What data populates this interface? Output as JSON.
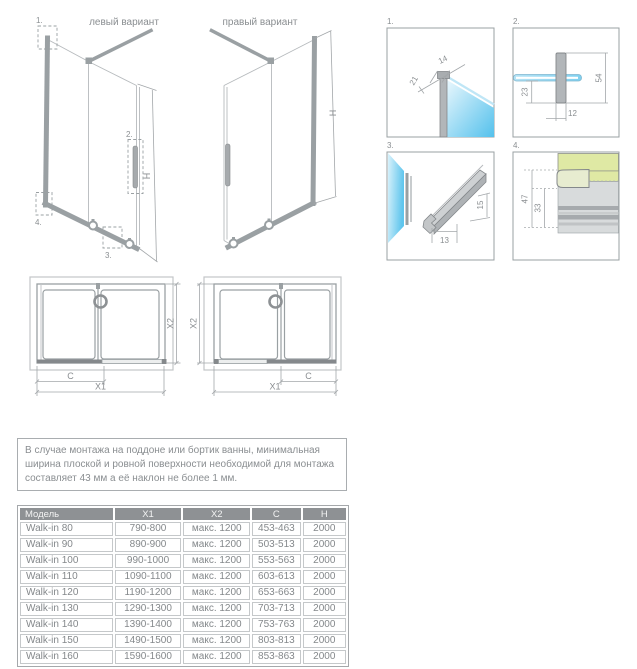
{
  "diagrams": {
    "left_variant": {
      "title": "левый вариант",
      "h_label": "H",
      "callouts": [
        "1.",
        "2.",
        "3.",
        "4."
      ]
    },
    "right_variant": {
      "title": "правый вариант",
      "h_label": "H"
    },
    "details": [
      {
        "number": "1.",
        "dims": [
          "21",
          "14"
        ]
      },
      {
        "number": "2.",
        "dims": [
          "54",
          "23",
          "12"
        ]
      },
      {
        "number": "3.",
        "dims": [
          "13",
          "15"
        ]
      },
      {
        "number": "4.",
        "dims": [
          "47",
          "33"
        ]
      }
    ],
    "plans": {
      "left": {
        "c": "C",
        "x1": "X1",
        "x2": "X2"
      },
      "right": {
        "c": "C",
        "x1": "X1",
        "x2": "X2"
      }
    }
  },
  "note": "В случае монтажа на поддоне или бортик ванны, минимальная ширина плоской и ровной поверхности необходимой для монтажа составляет 43 мм а её наклон не более 1 мм.",
  "table": {
    "columns": [
      "Модель",
      "X1",
      "X2",
      "C",
      "H"
    ],
    "rows": [
      [
        "Walk-in 80",
        "790-800",
        "макс. 1200",
        "453-463",
        "2000"
      ],
      [
        "Walk-in 90",
        "890-900",
        "макс. 1200",
        "503-513",
        "2000"
      ],
      [
        "Walk-in 100",
        "990-1000",
        "макс. 1200",
        "553-563",
        "2000"
      ],
      [
        "Walk-in 110",
        "1090-1100",
        "макс. 1200",
        "603-613",
        "2000"
      ],
      [
        "Walk-in 120",
        "1190-1200",
        "макс. 1200",
        "653-663",
        "2000"
      ],
      [
        "Walk-in 130",
        "1290-1300",
        "макс. 1200",
        "703-713",
        "2000"
      ],
      [
        "Walk-in 140",
        "1390-1400",
        "макс. 1200",
        "753-763",
        "2000"
      ],
      [
        "Walk-in 150",
        "1490-1500",
        "макс. 1200",
        "803-813",
        "2000"
      ],
      [
        "Walk-in 160",
        "1590-1600",
        "макс. 1200",
        "853-863",
        "2000"
      ]
    ]
  },
  "colors": {
    "line": "#9aa0a3",
    "text": "#8a8e91",
    "glass_blue": "#54c1ec",
    "tray_green": "#dfe9a4",
    "rail_dark": "#85898c",
    "table_header_bg": "#8e9194"
  }
}
